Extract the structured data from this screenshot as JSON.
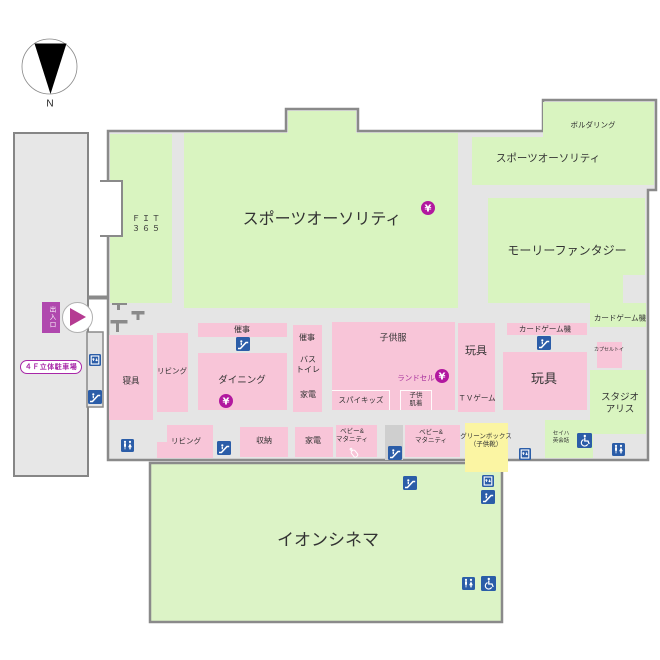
{
  "palette": {
    "green": "#d9f4c0",
    "cinema_green": "#dcf3c6",
    "pink": "#f8c5d8",
    "yellow": "#fbf5a3",
    "gray": "#e5e5e5",
    "gray2": "#cfcfcf",
    "wall": "#8a8a8a",
    "blue": "#2b5da8",
    "yen_magenta": "#b2189f",
    "magenta_text": "#a7309c"
  },
  "compass": {
    "label": "N"
  },
  "parking": {
    "label": "４Ｆ立体駐車場",
    "entrance_label": "出入口"
  },
  "areas": [
    {
      "id": "fit365",
      "color": "green",
      "rect": [
        110,
        134,
        62,
        169
      ]
    },
    {
      "id": "sports-authority-main",
      "color": "green",
      "rect": [
        184,
        133,
        274,
        175
      ]
    },
    {
      "id": "sports-authority-bump",
      "color": "green",
      "rect": [
        288,
        111,
        68,
        24
      ]
    },
    {
      "id": "sports-authority-upper",
      "color": "green",
      "rect": [
        472,
        137,
        71,
        48
      ]
    },
    {
      "id": "bouldering",
      "color": "green",
      "rect": [
        543,
        102,
        111,
        83
      ]
    },
    {
      "id": "molly-fantasy",
      "color": "green",
      "rect": [
        488,
        198,
        157,
        105
      ]
    },
    {
      "id": "molly-notch",
      "color": "gray",
      "rect": [
        623,
        275,
        22,
        28
      ]
    },
    {
      "id": "card-game-right",
      "color": "green",
      "rect": [
        590,
        303,
        56,
        24
      ]
    },
    {
      "id": "studio-alice",
      "color": "green",
      "rect": [
        590,
        370,
        56,
        64
      ]
    },
    {
      "id": "seiha-english",
      "color": "green",
      "rect": [
        545,
        420,
        48,
        38
      ]
    },
    {
      "id": "bedding",
      "color": "pink",
      "rect": [
        109,
        335,
        44,
        85
      ]
    },
    {
      "id": "living-upper",
      "color": "pink",
      "rect": [
        157,
        333,
        31,
        79
      ]
    },
    {
      "id": "event-strip",
      "color": "pink",
      "rect": [
        198,
        323,
        89,
        14
      ]
    },
    {
      "id": "dining",
      "color": "pink",
      "rect": [
        198,
        353,
        89,
        57
      ]
    },
    {
      "id": "event-bath-appliance-column",
      "color": "pink",
      "rect": [
        293,
        325,
        29,
        87
      ]
    },
    {
      "id": "kids-clothing",
      "color": "pink",
      "rect": [
        332,
        322,
        123,
        88
      ]
    },
    {
      "id": "spy-kids",
      "color": "pink",
      "rect": [
        332,
        390,
        58,
        20
      ],
      "dividers": [
        "top",
        "right"
      ]
    },
    {
      "id": "kids-underwear",
      "color": "pink",
      "rect": [
        400,
        390,
        32,
        20
      ],
      "dividers": [
        "top",
        "left",
        "right"
      ]
    },
    {
      "id": "toys-left",
      "color": "pink",
      "rect": [
        458,
        323,
        37,
        89
      ]
    },
    {
      "id": "card-game-strip",
      "color": "pink",
      "rect": [
        507,
        323,
        80,
        12
      ]
    },
    {
      "id": "toys-big",
      "color": "pink",
      "rect": [
        503,
        352,
        84,
        58
      ]
    },
    {
      "id": "capsule-toy",
      "color": "pink",
      "rect": [
        597,
        342,
        25,
        26
      ]
    },
    {
      "id": "living-lower-step",
      "color": "pink",
      "rect": [
        157,
        442,
        11,
        16
      ]
    },
    {
      "id": "living-lower",
      "color": "pink",
      "rect": [
        167,
        425,
        46,
        33
      ]
    },
    {
      "id": "storage",
      "color": "pink",
      "rect": [
        240,
        427,
        48,
        30
      ]
    },
    {
      "id": "appliance-lower",
      "color": "pink",
      "rect": [
        295,
        427,
        38,
        30
      ]
    },
    {
      "id": "baby-maternity-1",
      "color": "pink",
      "rect": [
        336,
        425,
        41,
        32
      ]
    },
    {
      "id": "escalator-well",
      "color": "gray2",
      "rect": [
        385,
        425,
        18,
        35
      ]
    },
    {
      "id": "baby-maternity-2",
      "color": "pink",
      "rect": [
        405,
        425,
        55,
        32
      ]
    },
    {
      "id": "green-box",
      "color": "yellow",
      "rect": [
        465,
        423,
        43,
        49
      ]
    }
  ],
  "labels": [
    {
      "id": "sports-authority-main-label",
      "lines": [
        "スポーツオーソリティ"
      ],
      "x": 322,
      "y": 220,
      "size": 16
    },
    {
      "id": "fit365-label",
      "lines": [
        "ＦＩＴ",
        "３６５"
      ],
      "x": 147,
      "y": 224,
      "size": 8,
      "ls": 2
    },
    {
      "id": "bouldering-label",
      "lines": [
        "ボルダリング"
      ],
      "x": 593,
      "y": 125,
      "size": 7.5
    },
    {
      "id": "sports-authority-upper-label",
      "lines": [
        "スポーツオーソリティ"
      ],
      "x": 548,
      "y": 159,
      "size": 10.5
    },
    {
      "id": "molly-fantasy-label",
      "lines": [
        "モーリーファンタジー"
      ],
      "x": 567,
      "y": 251,
      "size": 12
    },
    {
      "id": "card-game-right-label",
      "lines": [
        "カードゲーム機"
      ],
      "x": 620,
      "y": 318,
      "size": 7.5
    },
    {
      "id": "card-game-strip-label",
      "lines": [
        "カードゲーム機"
      ],
      "x": 545,
      "y": 329,
      "size": 7.5
    },
    {
      "id": "toys-big-label",
      "lines": [
        "玩具"
      ],
      "x": 544,
      "y": 379,
      "size": 13
    },
    {
      "id": "toys-left-label",
      "lines": [
        "玩具"
      ],
      "x": 476,
      "y": 352,
      "size": 11
    },
    {
      "id": "tv-game-label",
      "lines": [
        "ＴＶゲーム"
      ],
      "x": 477,
      "y": 398,
      "size": 7.5
    },
    {
      "id": "capsule-toy-label",
      "lines": [
        "カプセルトイ"
      ],
      "x": 609,
      "y": 350,
      "size": 5
    },
    {
      "id": "studio-alice-label",
      "lines": [
        "スタジオ",
        "アリス"
      ],
      "x": 620,
      "y": 404,
      "size": 9.5
    },
    {
      "id": "kids-clothing-label",
      "lines": [
        "子供服"
      ],
      "x": 393,
      "y": 338,
      "size": 9
    },
    {
      "id": "randoseru-label",
      "lines": [
        "ランドセル"
      ],
      "x": 416,
      "y": 378,
      "size": 7.5,
      "color": "magenta"
    },
    {
      "id": "spy-kids-label",
      "lines": [
        "スパイキッズ"
      ],
      "x": 361,
      "y": 400,
      "size": 7.5
    },
    {
      "id": "kids-underwear-label",
      "lines": [
        "子供",
        "肌着"
      ],
      "x": 416,
      "y": 400,
      "size": 6.5
    },
    {
      "id": "event-strip-label",
      "lines": [
        "催事"
      ],
      "x": 242,
      "y": 330,
      "size": 8
    },
    {
      "id": "dining-label",
      "lines": [
        "ダイニング"
      ],
      "x": 242,
      "y": 381,
      "size": 9.5
    },
    {
      "id": "event-column-label",
      "lines": [
        "催事"
      ],
      "x": 307,
      "y": 338,
      "size": 8
    },
    {
      "id": "bath-toilet-label",
      "lines": [
        "バス",
        "トイレ"
      ],
      "x": 308,
      "y": 365,
      "size": 8
    },
    {
      "id": "appliance-column-label",
      "lines": [
        "家電"
      ],
      "x": 308,
      "y": 395,
      "size": 8
    },
    {
      "id": "living-upper-label",
      "lines": [
        "リビング"
      ],
      "x": 172,
      "y": 371,
      "size": 7.5
    },
    {
      "id": "bedding-label",
      "lines": [
        "寝具"
      ],
      "x": 131,
      "y": 381,
      "size": 8.5
    },
    {
      "id": "living-lower-label",
      "lines": [
        "リビング"
      ],
      "x": 186,
      "y": 441,
      "size": 7.5
    },
    {
      "id": "storage-label",
      "lines": [
        "収納"
      ],
      "x": 264,
      "y": 441,
      "size": 8
    },
    {
      "id": "appliance-lower-label",
      "lines": [
        "家電"
      ],
      "x": 313,
      "y": 441,
      "size": 8
    },
    {
      "id": "baby-maternity-1-label",
      "lines": [
        "ベビー&",
        "マタニティ"
      ],
      "x": 352,
      "y": 436,
      "size": 6.5
    },
    {
      "id": "baby-maternity-2-label",
      "lines": [
        "ベビー&",
        "マタニティ"
      ],
      "x": 431,
      "y": 437,
      "size": 6.5
    },
    {
      "id": "green-box-label",
      "lines": [
        "グリーンボックス",
        "（子供靴）"
      ],
      "x": 486,
      "y": 441,
      "size": 6.5
    },
    {
      "id": "seiha-english-label",
      "lines": [
        "セイハ",
        "英会話"
      ],
      "x": 561,
      "y": 438,
      "size": 5.5
    },
    {
      "id": "aeon-cinema-label",
      "lines": [
        "イオンシネマ"
      ],
      "x": 328,
      "y": 540,
      "size": 17
    }
  ],
  "icons": [
    {
      "type": "yen",
      "x": 421,
      "y": 201
    },
    {
      "type": "yen",
      "x": 219,
      "y": 394
    },
    {
      "type": "yen",
      "x": 435,
      "y": 369
    },
    {
      "type": "escalator",
      "x": 236,
      "y": 337
    },
    {
      "type": "escalator",
      "x": 217,
      "y": 441
    },
    {
      "type": "escalator",
      "x": 388,
      "y": 446
    },
    {
      "type": "escalator",
      "x": 537,
      "y": 336
    },
    {
      "type": "escalator",
      "x": 88,
      "y": 390
    },
    {
      "type": "escalator",
      "x": 403,
      "y": 476
    },
    {
      "type": "escalator",
      "x": 481,
      "y": 490
    },
    {
      "type": "elevator",
      "x": 89,
      "y": 354
    },
    {
      "type": "elevator",
      "x": 519,
      "y": 448
    },
    {
      "type": "elevator",
      "x": 482,
      "y": 475
    },
    {
      "type": "restroom",
      "x": 121,
      "y": 439
    },
    {
      "type": "restroom",
      "x": 612,
      "y": 443
    },
    {
      "type": "restroom",
      "x": 462,
      "y": 577
    },
    {
      "type": "wheelchair",
      "x": 577,
      "y": 433
    },
    {
      "type": "wheelchair",
      "x": 481,
      "y": 576
    },
    {
      "type": "nursing",
      "x": 347,
      "y": 446
    }
  ]
}
